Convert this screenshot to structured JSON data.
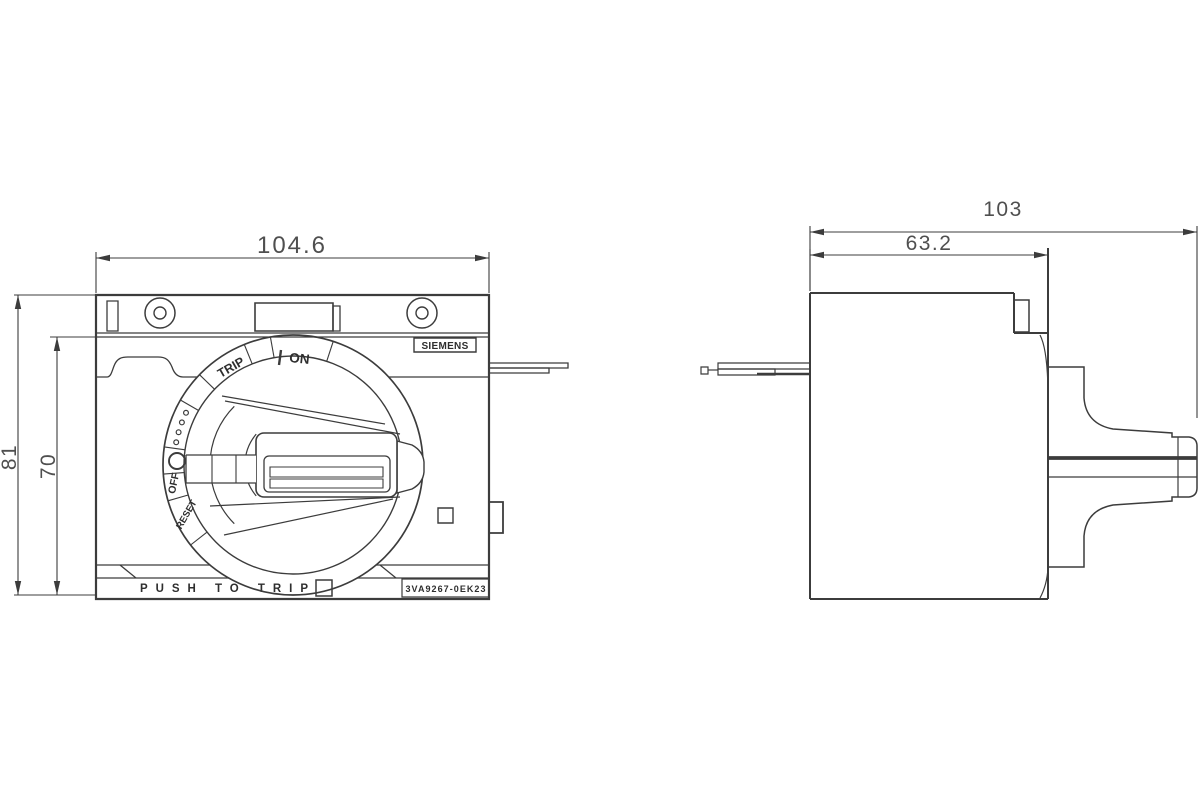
{
  "drawing": {
    "brand": "SIEMENS",
    "part_number": "3VA9267-0EK23",
    "front_view": {
      "dims": {
        "width": "104.6",
        "height": "81",
        "height_inner": "70"
      },
      "dial": {
        "trip": "TRIP",
        "on": "ON",
        "off": "OFF",
        "reset": "RESET"
      },
      "push_to_trip": "PUSH TO TRIP"
    },
    "side_view": {
      "dims": {
        "total_width": "103",
        "body_depth": "63.2"
      }
    },
    "colors": {
      "line": "#3c3c3c",
      "text": "#4f4f4f",
      "background": "#ffffff"
    }
  }
}
